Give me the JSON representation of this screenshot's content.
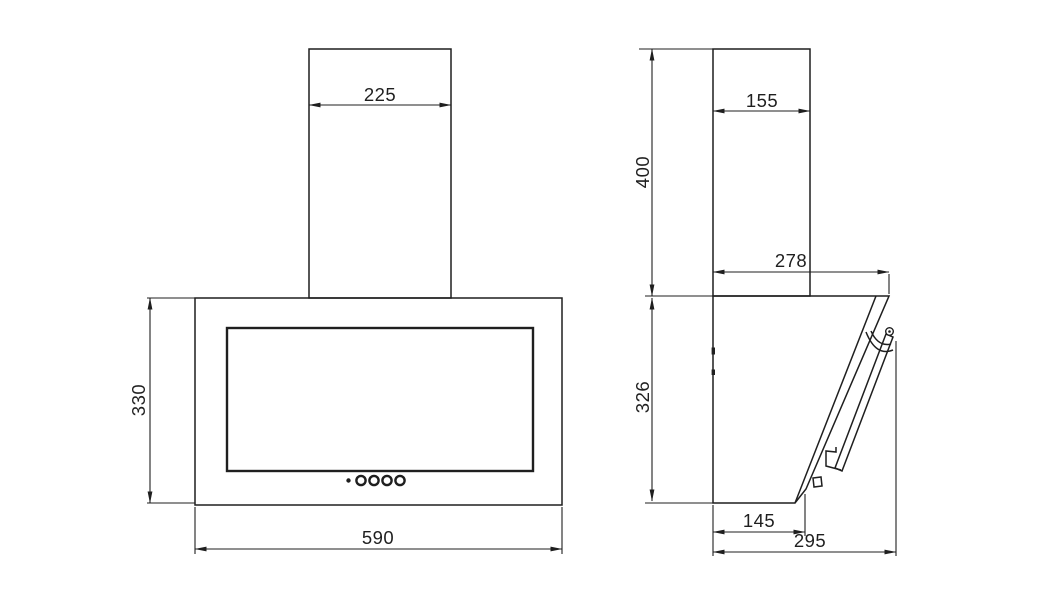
{
  "figure": {
    "kind": "technical dimension drawing",
    "subject": "wall-mounted angled cooker hood, front and side views"
  },
  "colors": {
    "line": "#1f1f1f",
    "background": "#ffffff"
  },
  "front_view": {
    "dims": {
      "duct_width": "225",
      "body_height": "330",
      "body_width": "590"
    },
    "controls": {
      "button_count": 4,
      "indicator_dot_count": 1
    }
  },
  "side_view": {
    "dims": {
      "duct_depth": "155",
      "duct_height": "400",
      "body_top_depth": "278",
      "body_height": "326",
      "body_bottom_depth": "145",
      "overall_depth": "295"
    }
  }
}
